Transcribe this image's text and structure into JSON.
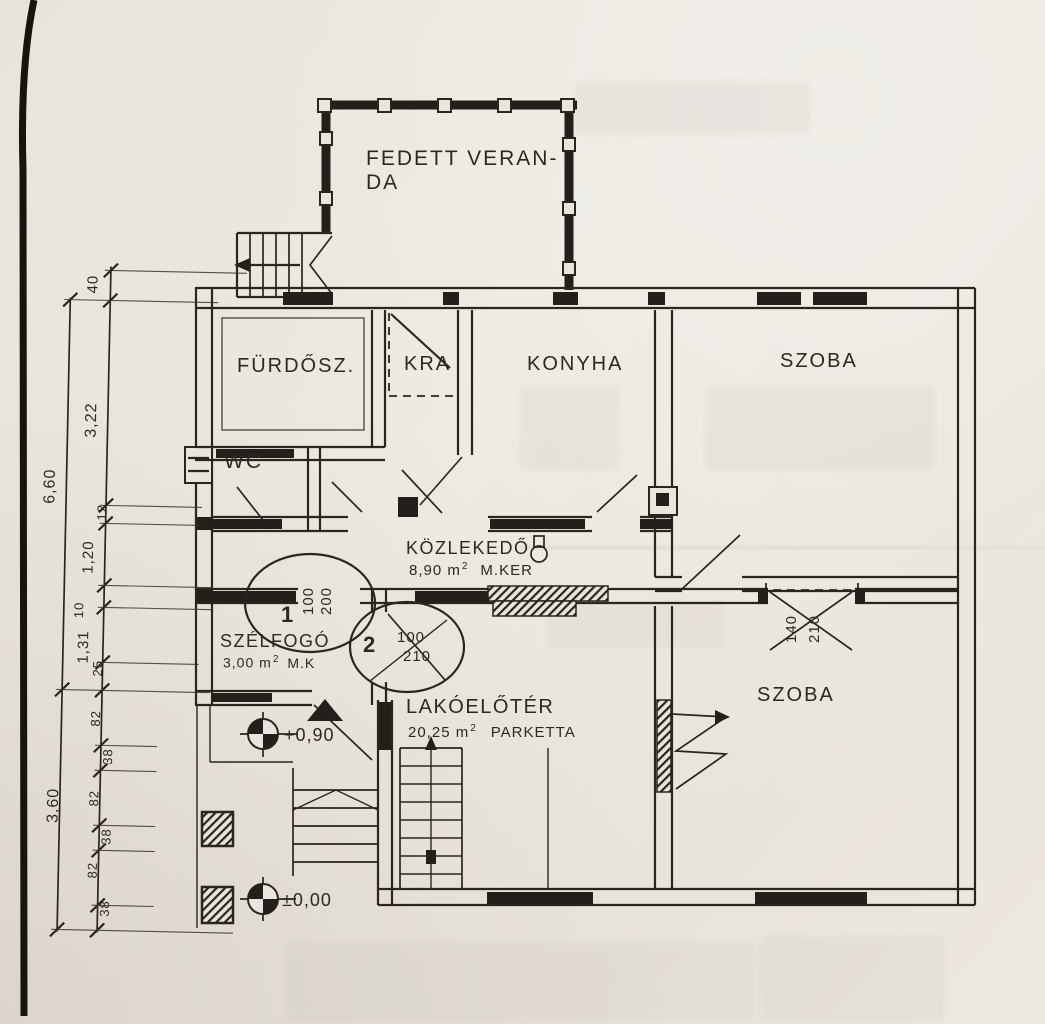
{
  "colors": {
    "paper": "#e9e5de",
    "ink": "#2b2520"
  },
  "rooms": {
    "veranda": {
      "line1": "FEDETT VERAN-",
      "line2": "DA"
    },
    "bathroom": {
      "label": "FÜRDŐSZ."
    },
    "pantry": {
      "label": "KRA"
    },
    "kitchen": {
      "label": "KONYHA"
    },
    "room_top": {
      "label": "SZOBA"
    },
    "wc": {
      "label": "WC"
    },
    "hall": {
      "label": "KÖZLEKEDŐ",
      "area": "8,90 m",
      "area_sup": "2",
      "finish": "M.KER"
    },
    "windbreak": {
      "label": "SZÉLFOGÓ",
      "area": "3,00 m",
      "area_sup": "2",
      "finish": "M.K"
    },
    "foyer": {
      "label": "LAKÓELŐTÉR",
      "area": "20,25 m",
      "area_sup": "2",
      "finish": "PARKETTA"
    },
    "room_bottom": {
      "label": "SZOBA"
    }
  },
  "doors": {
    "door1": {
      "num": "1",
      "width": "100",
      "height": "200"
    },
    "door2": {
      "num": "2",
      "width": "100",
      "height": "210"
    },
    "door3": {
      "width": "140",
      "height": "210"
    }
  },
  "levels": {
    "entry": "+0,90",
    "ground": "±0,00"
  },
  "dims": {
    "outer": {
      "total_upper": "6,60",
      "total_lower": "3,60"
    },
    "inner": {
      "d40": "40",
      "d322": "3,22",
      "d12": "12",
      "d120": "1,20",
      "d10": "10",
      "d131": "1,31",
      "d25": "25",
      "d82": "82",
      "d38": "38"
    }
  }
}
